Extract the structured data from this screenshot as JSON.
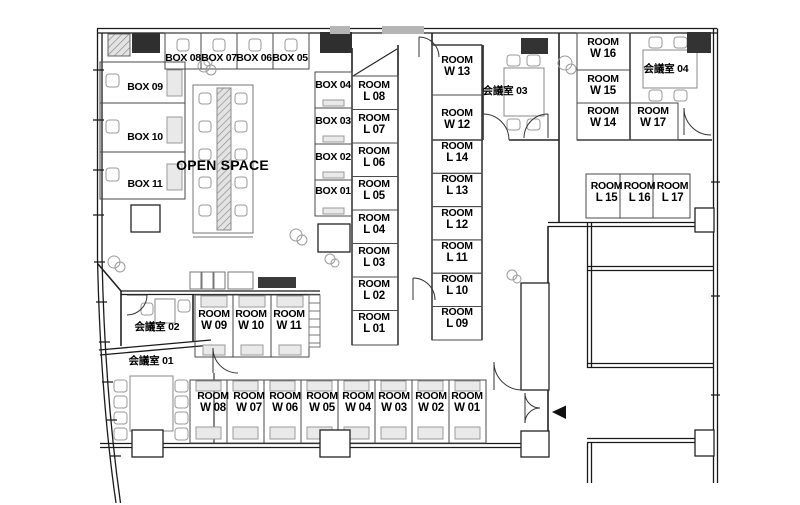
{
  "plan": {
    "open_space": "OPEN SPACE",
    "room_word": "ROOM",
    "boxes_top": [
      "BOX 08",
      "BOX 07",
      "BOX 06",
      "BOX 05"
    ],
    "boxes_left": [
      "BOX 09",
      "BOX 10",
      "BOX 11"
    ],
    "boxes_right": [
      "BOX 04",
      "BOX 03",
      "BOX 02",
      "BOX 01"
    ],
    "rooms_l_left": [
      "L 08",
      "L 07",
      "L 06",
      "L 05",
      "L 04",
      "L 03",
      "L 02",
      "L 01"
    ],
    "rooms_w_mid": [
      "W 13",
      "W 12"
    ],
    "rooms_l_mid": [
      "L 14",
      "L 13",
      "L 12",
      "L 11",
      "L 10",
      "L 09"
    ],
    "rooms_w_right_col": [
      "W 16",
      "W 15",
      "W 14"
    ],
    "room_w17": "W 17",
    "rooms_l_right_row": [
      "L 15",
      "L 16",
      "L 17"
    ],
    "rooms_w_upper_row": [
      "W 09",
      "W 10",
      "W 11"
    ],
    "rooms_w_bottom_row": [
      "W 08",
      "W 07",
      "W 06",
      "W 05",
      "W 04",
      "W 03",
      "W 02",
      "W 01"
    ],
    "meeting_rooms": {
      "m01": "会議室 01",
      "m02": "会議室 02",
      "m03": "会議室 03",
      "m04": "会議室 04"
    },
    "entry_arrow_icon": "left-triangle",
    "colors": {
      "wall": "#1a1a1a",
      "cell_line": "#4a4a4a",
      "furniture": "#9a9a9a",
      "dark_fixture": "#333333"
    }
  }
}
